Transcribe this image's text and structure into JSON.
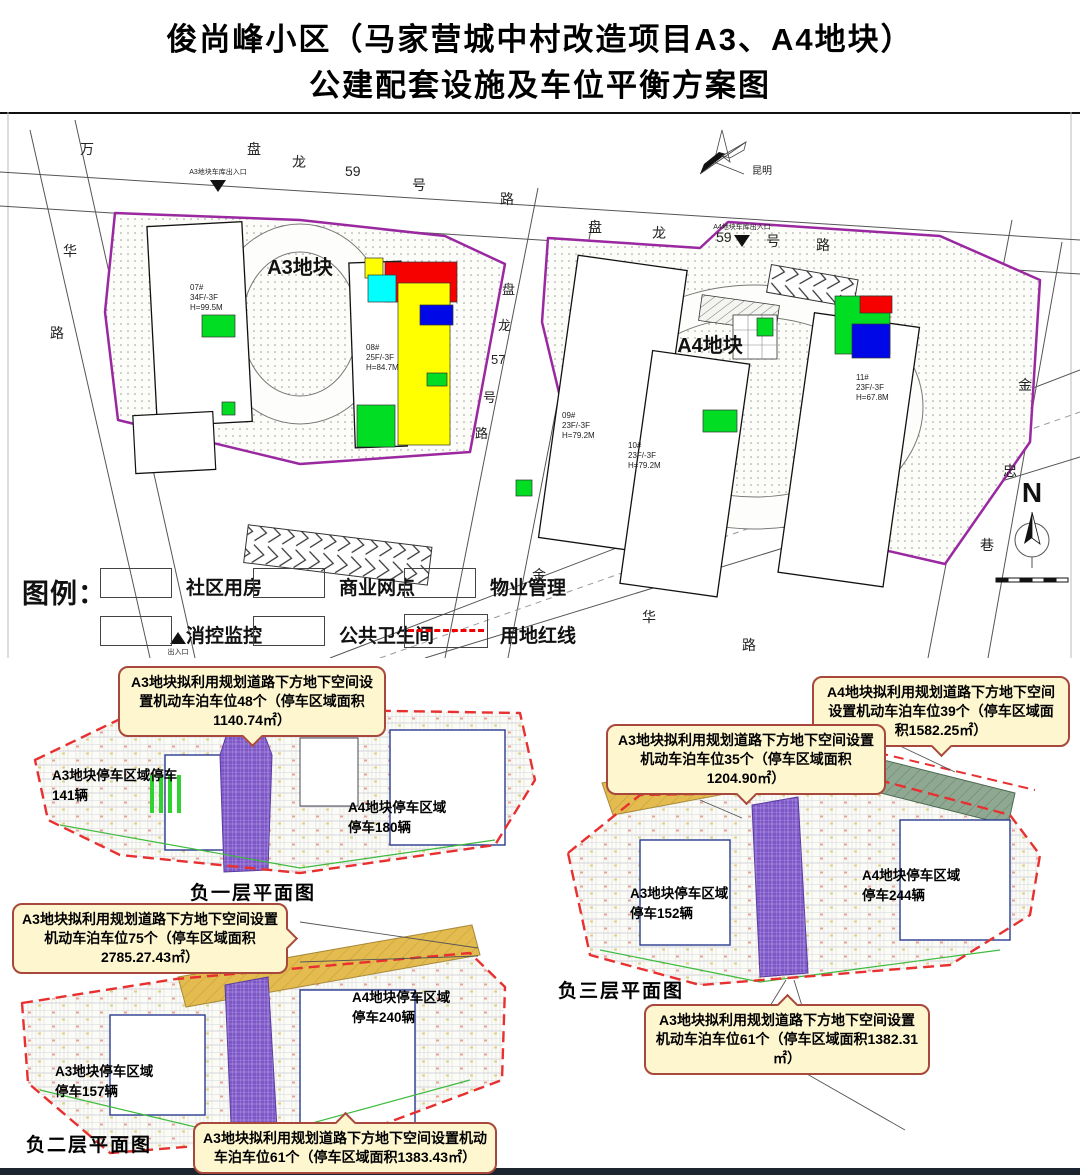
{
  "title": {
    "line1": "俊尚峰小区（马家营城中村改造项目A3、A4地块）",
    "line2": "公建配套设施及车位平衡方案图"
  },
  "site_plan": {
    "plots": {
      "a3": "A3地块",
      "a4": "A4地块"
    },
    "roads": {
      "panlong59_left": [
        "盘",
        "龙",
        "59",
        "号",
        "路"
      ],
      "panlong59_right": [
        "盘",
        "龙",
        "59",
        "号",
        "路"
      ],
      "panlong57": [
        "盘",
        "龙",
        "57",
        "号",
        "路"
      ],
      "jinhua": [
        "金",
        "华",
        "路"
      ],
      "wanhua": [
        "万",
        "华",
        "路"
      ],
      "jinzhong": [
        "金",
        "忠",
        "巷"
      ]
    },
    "entrances": {
      "a3_garage": "A3地块车库出入口",
      "a4_garage": "A4地块车库出入口",
      "south": "出入口"
    },
    "buildings": {
      "b07": {
        "id": "07#",
        "floors": "34F/-3F",
        "height": "H=99.5M"
      },
      "b08": {
        "id": "08#",
        "floors": "25F/-3F",
        "height": "H=84.7M"
      },
      "b09": {
        "id": "09#",
        "floors": "23F/-3F",
        "height": "H=79.2M"
      },
      "b10": {
        "id": "10#",
        "floors": "23F/-3F",
        "height": "H=79.2M"
      },
      "b11": {
        "id": "11#",
        "floors": "23F/-3F",
        "height": "H=67.8M"
      }
    },
    "compass_city": "昆明",
    "north": "N"
  },
  "legend": {
    "title": "图例：",
    "items": [
      {
        "label": "社区用房",
        "swatch_css": "background:#ffff00"
      },
      {
        "label": "商业网点",
        "swatch_css": "background:#f70000"
      },
      {
        "label": "物业管理",
        "swatch_css": "background:#00dd22"
      },
      {
        "label": "消控监控",
        "swatch_css": "background:#00ffff"
      },
      {
        "label": "公共卫生间",
        "swatch_css": "background:#0008e8"
      },
      {
        "label": "用地红线",
        "swatch_css": "background:#ffffff"
      }
    ],
    "redline_color": "#f00000"
  },
  "basements": {
    "b1": {
      "caption": "负一层平面图",
      "a3": "A3地块停车区域停车\n141辆",
      "a4": "A4地块停车区域\n停车180辆"
    },
    "b2": {
      "caption": "负二层平面图",
      "a3": "A3地块停车区域\n停车157辆",
      "a4": "A4地块停车区域\n停车240辆"
    },
    "b3": {
      "caption": "负三层平面图",
      "a3": "A3地块停车区域\n停车152辆",
      "a4": "A4地块停车区域\n停车244辆"
    }
  },
  "callouts": {
    "c1": "A3地块拟利用规划道路下方地下空间设置机动车泊车位48个（停车区域面积1140.74㎡）",
    "c2": "A3地块拟利用规划道路下方地下空间设置机动车泊车位75个（停车区域面积2785.27.43㎡）",
    "c3": "A3地块拟利用规划道路下方地下空间设置机动车泊车位61个（停车区域面积1383.43㎡）",
    "c4": "A4地块拟利用规划道路下方地下空间设置机动车泊车位39个（停车区域面积1582.25㎡）",
    "c5": "A3地块拟利用规划道路下方地下空间设置机动车泊车位35个（停车区域面积1204.90㎡）",
    "c6": "A3地块拟利用规划道路下方地下空间设置机动车泊车位61个（停车区域面积1382.31㎡）"
  }
}
